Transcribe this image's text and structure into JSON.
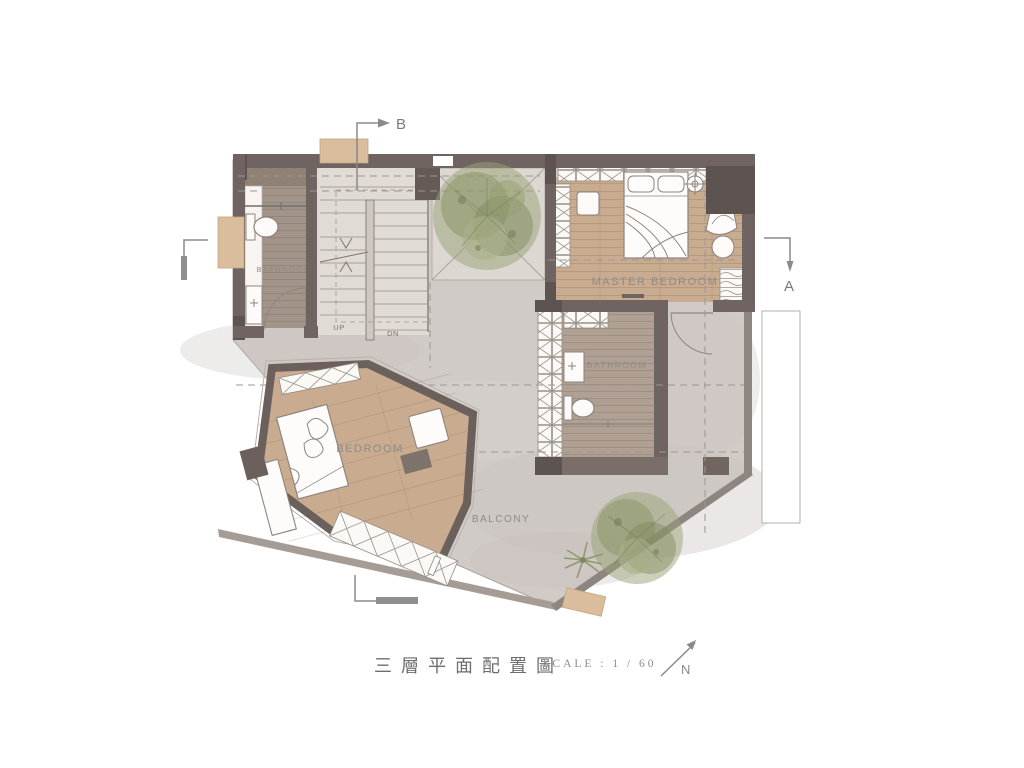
{
  "title_block": {
    "title": "三層平面配置圖",
    "scale_label": "SCALE : 1 / 60",
    "north_label": "N"
  },
  "section_markers": {
    "top_label": "B",
    "right_label": "A"
  },
  "rooms": {
    "bathroom_upper": "BATHROOM",
    "bathroom_middle": "BATHROOM",
    "master_bedroom": "MASTER BEDROOM",
    "bedroom": "BEDROOM",
    "balcony": "BALCONY"
  },
  "stairs": {
    "up": "UP",
    "down": "DN"
  },
  "palette": {
    "wall_dark": "#6f6461",
    "wall_darker": "#5d5350",
    "wood_tan": "#c9ac90",
    "wood_gray": "#a3948a",
    "concrete": "#d1cbc8",
    "stair_floor": "#e1dbd6",
    "tree_green": "#8c9467",
    "accent_tan_box": "#dabd9c",
    "label_gray": "#8f8b86"
  }
}
